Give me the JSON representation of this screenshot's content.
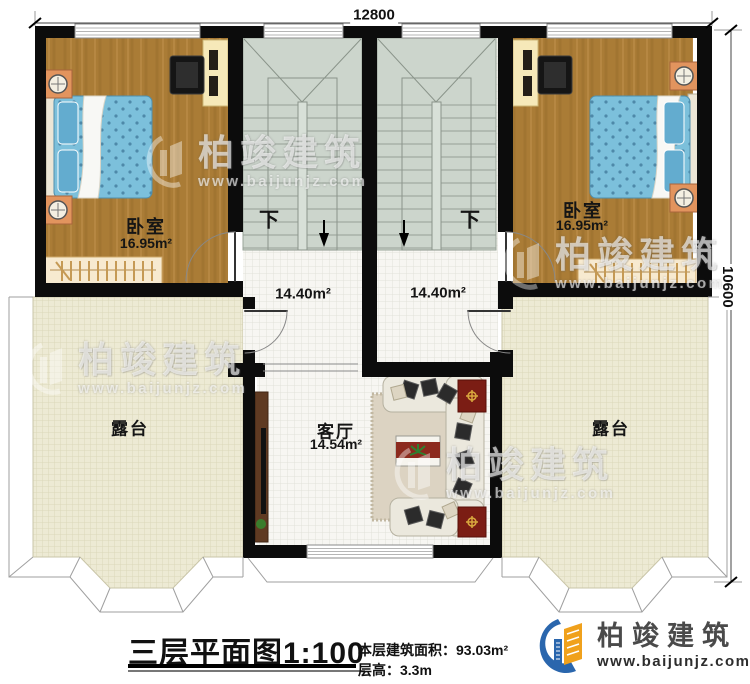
{
  "dimensions": {
    "top": "12800",
    "right": "10600"
  },
  "rooms": {
    "bedroom_left": {
      "name": "卧室",
      "area": "16.95m²"
    },
    "bedroom_right": {
      "name": "卧室",
      "area": "16.95m²"
    },
    "stairhall_left": {
      "down": "下",
      "area": "14.40m²"
    },
    "stairhall_right": {
      "down": "下",
      "area": "14.40m²"
    },
    "living_room": {
      "name": "客厅",
      "area": "14.54m²"
    },
    "terrace_left": {
      "name": "露台"
    },
    "terrace_right": {
      "name": "露台"
    }
  },
  "title": {
    "main": "三层平面图",
    "scale": "1:100",
    "area_label": "本层建筑面积：",
    "area_value": "93.03m²",
    "height_label": "层高：",
    "height_value": "3.3m"
  },
  "brand": {
    "name": "柏竣建筑",
    "url": "www.baijunjz.com"
  },
  "watermark": {
    "name": "柏竣建筑",
    "url": "www.baijunjz.com"
  },
  "colors": {
    "wall": "#0c0c0c",
    "wood_floor": "#aa7c36",
    "bed": "#79bdd8",
    "stair": "#ccd5cc",
    "tile": "#f7f6f2",
    "terrace": "#edead4",
    "mat_red": "#7b1d14",
    "brand_blue": "#2a66ad",
    "brand_orange": "#f0a11c"
  }
}
